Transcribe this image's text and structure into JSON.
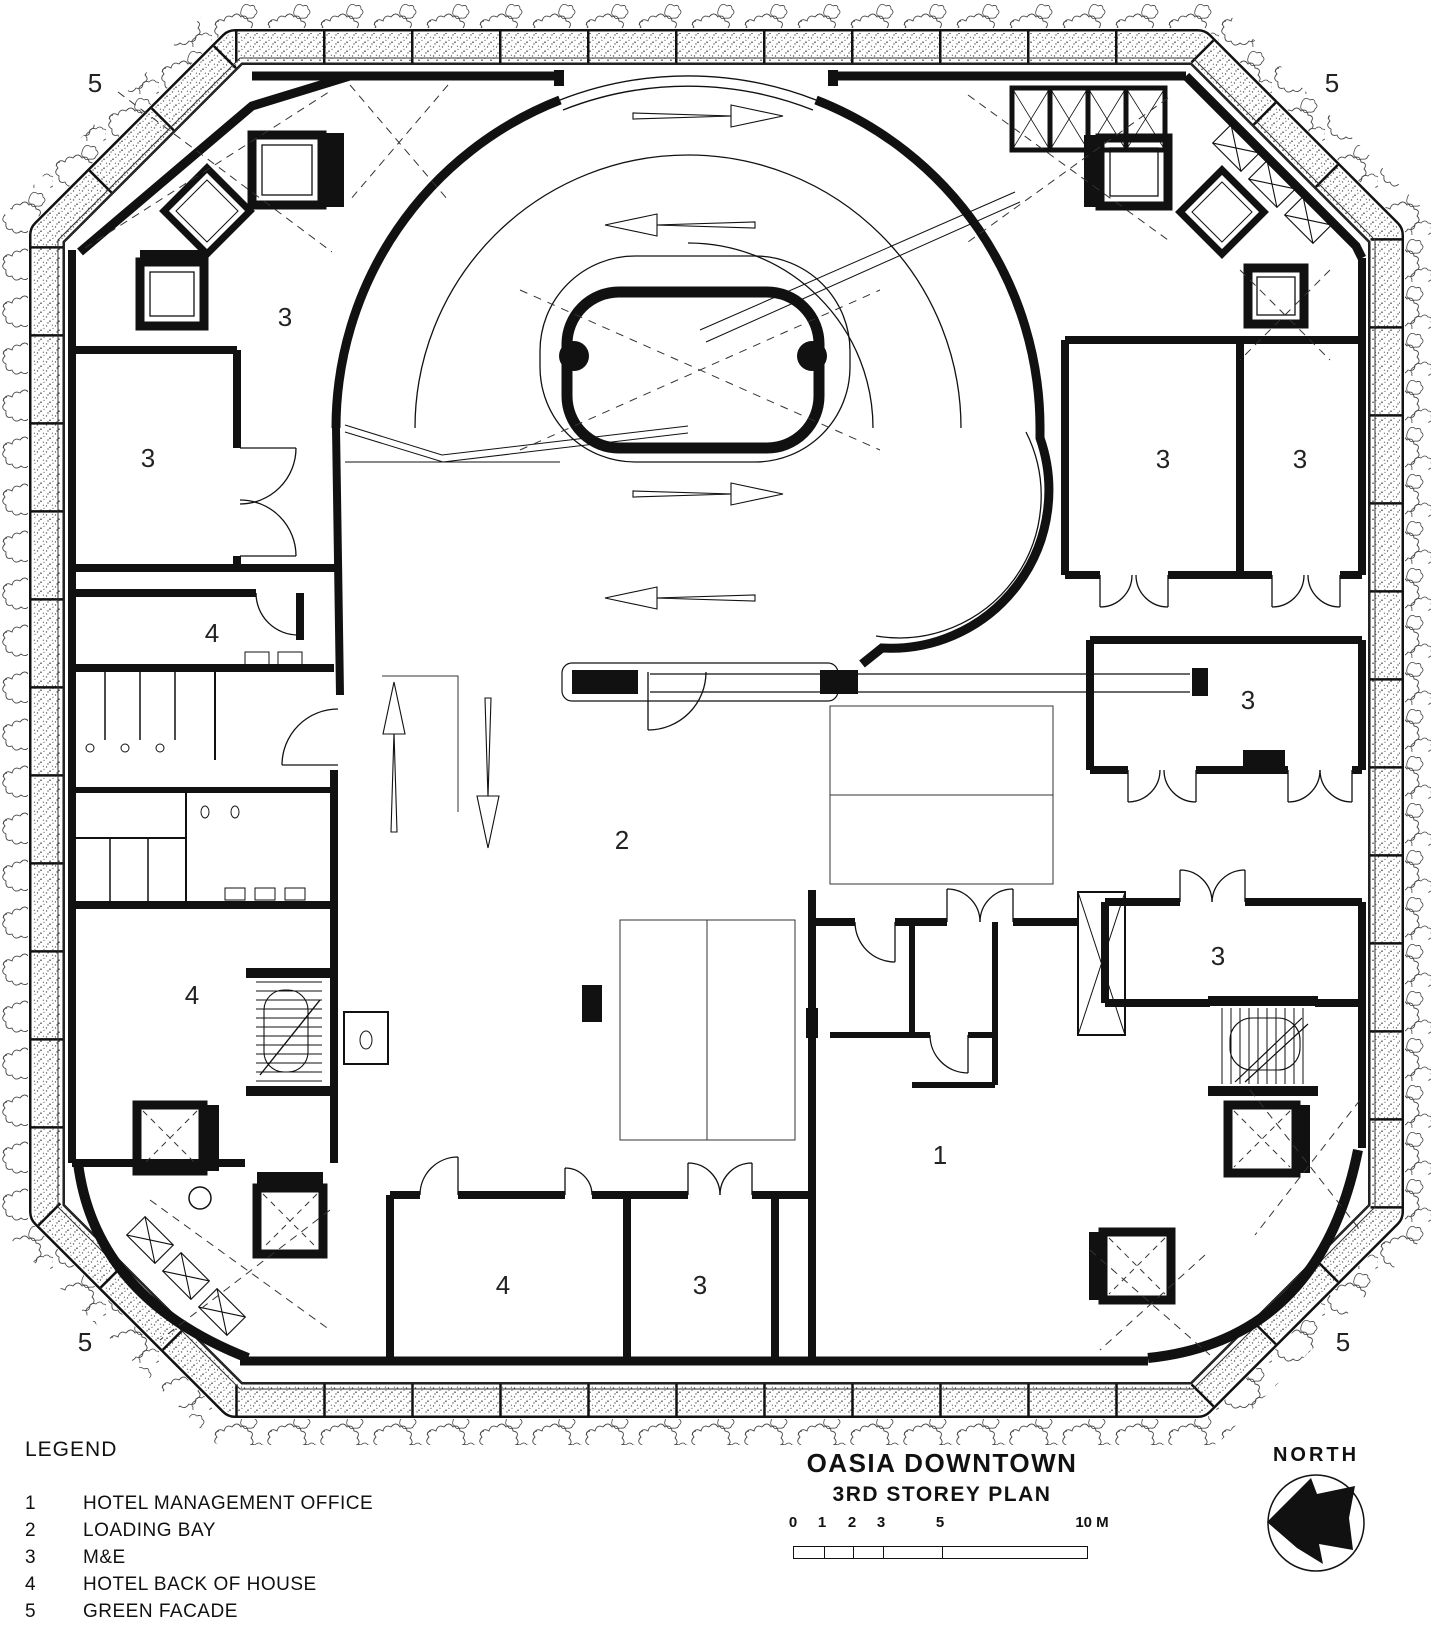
{
  "colors": {
    "ink": "#111111",
    "paper": "#ffffff",
    "stipple": "#555555"
  },
  "plan": {
    "room_labels": [
      {
        "text": "5",
        "x": 95,
        "y": 83
      },
      {
        "text": "5",
        "x": 1332,
        "y": 83
      },
      {
        "text": "3",
        "x": 285,
        "y": 317
      },
      {
        "text": "3",
        "x": 148,
        "y": 458
      },
      {
        "text": "4",
        "x": 212,
        "y": 633
      },
      {
        "text": "2",
        "x": 622,
        "y": 840
      },
      {
        "text": "4",
        "x": 192,
        "y": 995
      },
      {
        "text": "3",
        "x": 1163,
        "y": 459
      },
      {
        "text": "3",
        "x": 1300,
        "y": 459
      },
      {
        "text": "3",
        "x": 1248,
        "y": 700
      },
      {
        "text": "3",
        "x": 1218,
        "y": 956
      },
      {
        "text": "1",
        "x": 940,
        "y": 1155
      },
      {
        "text": "4",
        "x": 503,
        "y": 1285
      },
      {
        "text": "3",
        "x": 700,
        "y": 1285
      },
      {
        "text": "5",
        "x": 85,
        "y": 1342
      },
      {
        "text": "5",
        "x": 1343,
        "y": 1342
      }
    ]
  },
  "legend": {
    "title": "LEGEND",
    "items": [
      {
        "num": "1",
        "label": "HOTEL MANAGEMENT OFFICE"
      },
      {
        "num": "2",
        "label": "LOADING BAY"
      },
      {
        "num": "3",
        "label": "M&E"
      },
      {
        "num": "4",
        "label": "HOTEL BACK OF HOUSE"
      },
      {
        "num": "5",
        "label": "GREEN FACADE"
      }
    ]
  },
  "title_block": {
    "project": "OASIA DOWNTOWN",
    "sheet": "3RD STOREY PLAN"
  },
  "scale_bar": {
    "labels": [
      "0",
      "1",
      "2",
      "3",
      "5",
      "10 M"
    ]
  },
  "north": {
    "label": "NORTH"
  }
}
